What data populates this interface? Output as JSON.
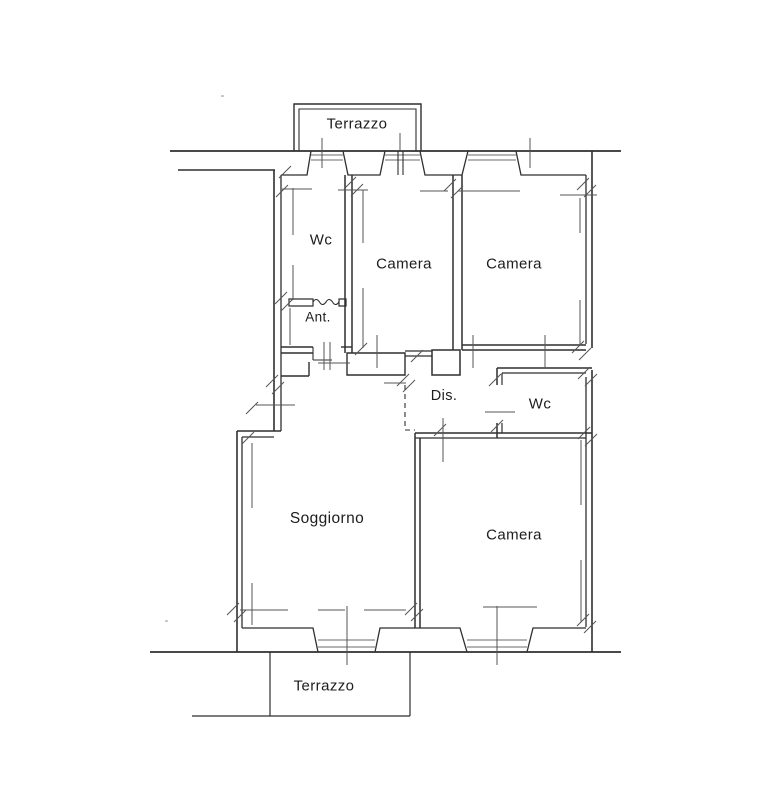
{
  "document": {
    "type": "apartment floor plan"
  },
  "colors": {
    "background": "#ffffff",
    "line": "#2f2f2f",
    "dim": "#555555",
    "glazing": "#6b6b6b",
    "label": "#1d1d1d"
  },
  "rooms": {
    "terrace_top": {
      "label": "Terrazzo"
    },
    "wc_top": {
      "label": "Wc"
    },
    "camera_top_left": {
      "label": "Camera"
    },
    "camera_top_right": {
      "label": "Camera"
    },
    "anteroom": {
      "label": "Ant."
    },
    "hallway": {
      "label": "Dis."
    },
    "wc_right": {
      "label": "Wc"
    },
    "living_room": {
      "label": "Soggiorno"
    },
    "camera_bottom": {
      "label": "Camera"
    },
    "terrace_bottom": {
      "label": "Terrazzo"
    }
  }
}
